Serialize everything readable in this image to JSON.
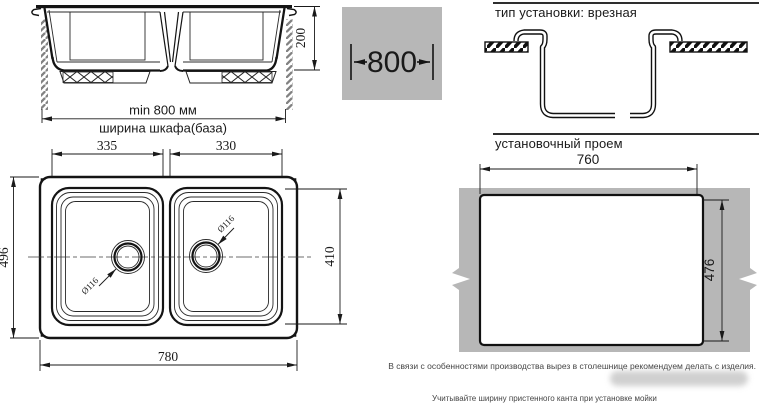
{
  "front_view": {
    "depth_dim": "200",
    "min_width_label": "min 800 мм",
    "cabinet_label": "ширина шкафа(база)"
  },
  "spec_box": {
    "cabinet_width": "800"
  },
  "installation": {
    "type_title": "тип установки: врезная",
    "opening_title": "установочный проем",
    "opening_width": "760",
    "opening_height": "476"
  },
  "top_view": {
    "left_bowl_width": "335",
    "right_bowl_width": "330",
    "overall_depth": "496",
    "bowl_length": "410",
    "overall_width": "780",
    "drain_left_diameter": "Ø116",
    "drain_right_diameter": "Ø116"
  },
  "notes": {
    "production_note": "В связи с особенностями производства вырез в столешнице рекомендуем делать с изделия.",
    "install_note": "Учитывайте ширину пристенного канта при установке мойки"
  },
  "colors": {
    "panel_gray": "#b7b7b7",
    "line_dark": "#1a1a1a"
  }
}
